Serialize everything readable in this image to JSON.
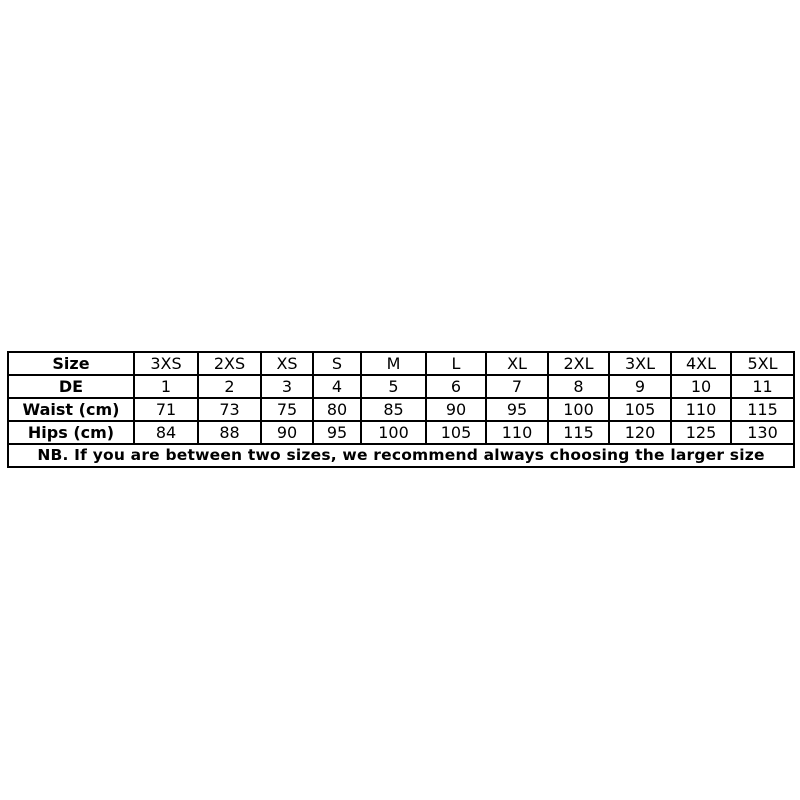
{
  "chart_data": {
    "type": "table",
    "title": "Size chart",
    "rows": [
      {
        "header": "Size",
        "cells": [
          "3XS",
          "2XS",
          "XS",
          "S",
          "M",
          "L",
          "XL",
          "2XL",
          "3XL",
          "4XL",
          "5XL"
        ]
      },
      {
        "header": "DE",
        "cells": [
          "1",
          "2",
          "3",
          "4",
          "5",
          "6",
          "7",
          "8",
          "9",
          "10",
          "11"
        ]
      },
      {
        "header": "Waist (cm)",
        "cells": [
          "71",
          "73",
          "75",
          "80",
          "85",
          "90",
          "95",
          "100",
          "105",
          "110",
          "115"
        ]
      },
      {
        "header": "Hips (cm)",
        "cells": [
          "84",
          "88",
          "90",
          "95",
          "100",
          "105",
          "110",
          "115",
          "120",
          "125",
          "130"
        ]
      }
    ],
    "note": "NB. If you are between two sizes, we recommend always choosing the larger size"
  },
  "colors": {
    "border": "#000000",
    "text": "#000000",
    "background": "#ffffff"
  }
}
